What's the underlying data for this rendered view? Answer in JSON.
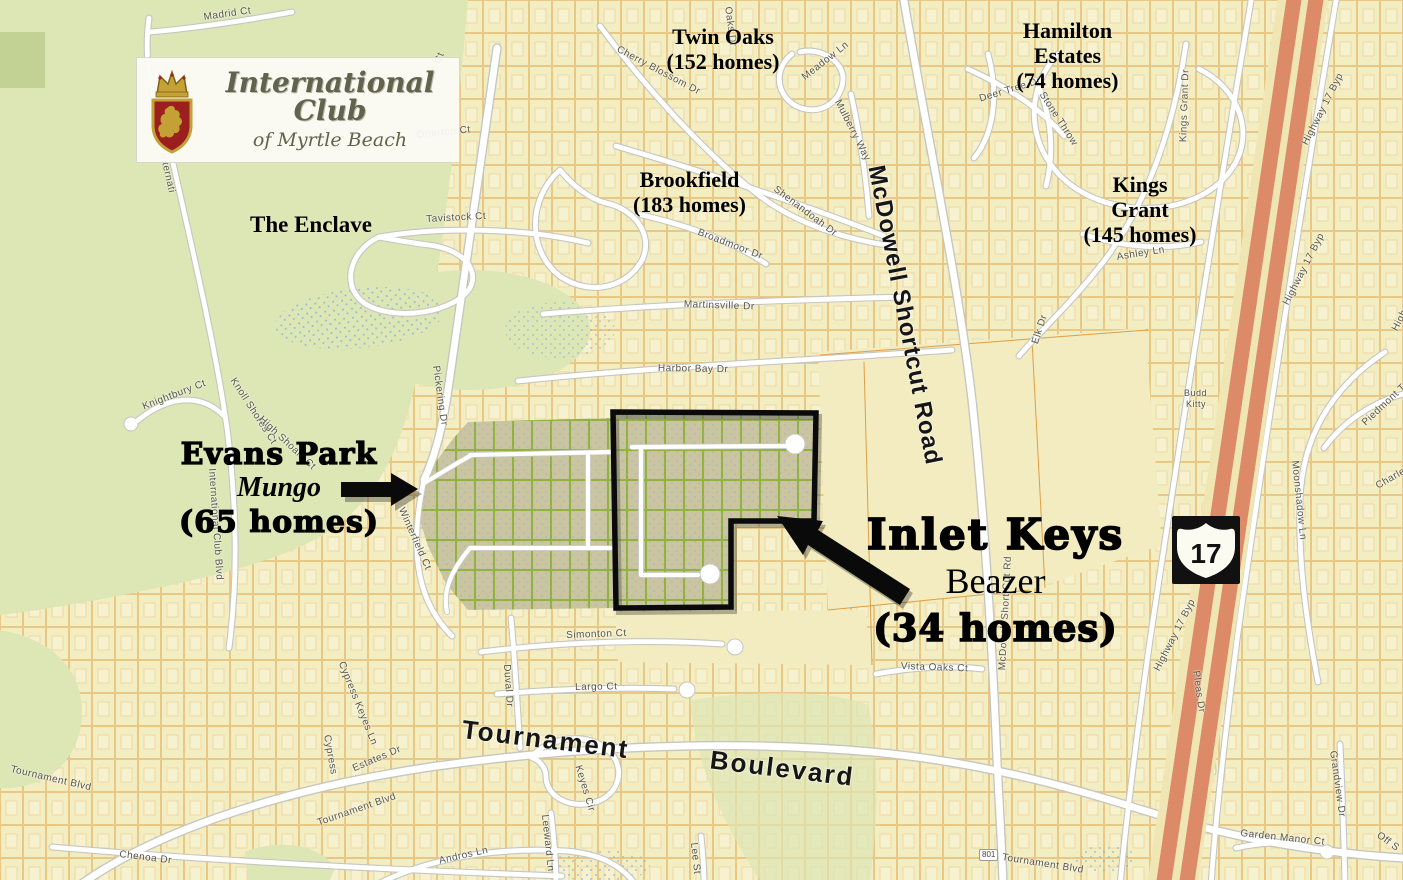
{
  "logo": {
    "title": "International Club",
    "subtitle": "of Myrtle Beach"
  },
  "shield": {
    "route": "17"
  },
  "markers": {
    "route_801": "801"
  },
  "neighborhoods": {
    "twin_oaks": {
      "name": "Twin Oaks",
      "homes": "(152 homes)"
    },
    "hamilton": {
      "name": "Hamilton\nEstates",
      "homes": "(74 homes)"
    },
    "brookfield": {
      "name": "Brookfield",
      "homes": "(183 homes)"
    },
    "kings_grant": {
      "name": "Kings\nGrant",
      "homes": "(145 homes)"
    },
    "enclave": {
      "name": "The Enclave"
    },
    "evans_park": {
      "name": "Evans Park",
      "builder": "Mungo",
      "homes": "(65 homes)"
    },
    "inlet_keys": {
      "name": "Inlet Keys",
      "builder": "Beazer",
      "homes": "(34 homes)"
    }
  },
  "streets": [
    {
      "t": "Madrid Ct",
      "x": 203,
      "y": 12,
      "r": -8
    },
    {
      "t": "Marsh Ct",
      "x": 420,
      "y": 92,
      "r": -68
    },
    {
      "t": "Otterton Ct",
      "x": 416,
      "y": 130,
      "r": -6
    },
    {
      "t": "Oaks Dr",
      "x": 733,
      "y": 6,
      "r": 82
    },
    {
      "t": "Cherry Blossom Dr",
      "x": 620,
      "y": 44,
      "r": 28
    },
    {
      "t": "Meadow Ln",
      "x": 800,
      "y": 74,
      "r": -38
    },
    {
      "t": "Mulberry Way",
      "x": 842,
      "y": 98,
      "r": 63
    },
    {
      "t": "Deer Tree Dr",
      "x": 978,
      "y": 94,
      "r": -17
    },
    {
      "t": "Stone Throw",
      "x": 1046,
      "y": 90,
      "r": 57
    },
    {
      "t": "Kings Grant Dr",
      "x": 1178,
      "y": 142,
      "r": -88
    },
    {
      "t": "Highway 17 Byp",
      "x": 1300,
      "y": 142,
      "r": -63
    },
    {
      "t": "Tavistock Ct",
      "x": 426,
      "y": 214,
      "r": -3
    },
    {
      "t": "Shenandoah Dr",
      "x": 778,
      "y": 184,
      "r": 37
    },
    {
      "t": "Broadmoor Dr",
      "x": 700,
      "y": 227,
      "r": 21
    },
    {
      "t": "Ashley Ln",
      "x": 1116,
      "y": 252,
      "r": -9
    },
    {
      "t": "Martinsville Dr",
      "x": 684,
      "y": 299,
      "r": 2
    },
    {
      "t": "Highway 17 Byp",
      "x": 1281,
      "y": 302,
      "r": -63
    },
    {
      "t": "Elk Dr",
      "x": 1030,
      "y": 342,
      "r": -72
    },
    {
      "t": "Harbor Bay Dr",
      "x": 658,
      "y": 363,
      "r": 1
    },
    {
      "t": "Piedmont Tr",
      "x": 1360,
      "y": 420,
      "r": -43
    },
    {
      "t": "Budd",
      "x": 1184,
      "y": 388,
      "r": 0,
      "s": 9
    },
    {
      "t": "Kitty",
      "x": 1186,
      "y": 399,
      "r": 0,
      "s": 9
    },
    {
      "t": "Knightbury Ct",
      "x": 141,
      "y": 402,
      "r": -21
    },
    {
      "t": "Knoll Shores Ct",
      "x": 237,
      "y": 376,
      "r": 57
    },
    {
      "t": "High Shoals Ct",
      "x": 264,
      "y": 414,
      "r": 43
    },
    {
      "t": "Pickering Dr",
      "x": 441,
      "y": 365,
      "r": 82
    },
    {
      "t": "Internati",
      "x": 168,
      "y": 152,
      "r": 77
    },
    {
      "t": "International Club Blvd",
      "x": 217,
      "y": 468,
      "r": 86
    },
    {
      "t": "Charleston",
      "x": 1374,
      "y": 482,
      "r": -30
    },
    {
      "t": "Moonshadow Ln",
      "x": 1300,
      "y": 460,
      "r": 84
    },
    {
      "t": "Winterfield Ct",
      "x": 406,
      "y": 506,
      "r": 66
    },
    {
      "t": "McDowell Shortcut Road",
      "x": 889,
      "y": 163,
      "r": 79,
      "s": 24,
      "w": 700,
      "c": "#161616",
      "ls": 1
    },
    {
      "t": "McDowell Short Cut Rd",
      "x": 997,
      "y": 670,
      "r": -87
    },
    {
      "t": "Highway 17 Byp",
      "x": 1152,
      "y": 668,
      "r": -63
    },
    {
      "t": "Highway 17 Byp",
      "x": 1390,
      "y": 328,
      "r": -63
    },
    {
      "t": "Vista Oaks Ct",
      "x": 901,
      "y": 661,
      "r": 2
    },
    {
      "t": "Simonton Ct",
      "x": 566,
      "y": 630,
      "r": -2
    },
    {
      "t": "Largo Ct",
      "x": 575,
      "y": 682,
      "r": -1
    },
    {
      "t": "Duval Dr",
      "x": 512,
      "y": 664,
      "r": 86
    },
    {
      "t": "Tournament   Boulevard",
      "x": 464,
      "y": 714,
      "r": 7,
      "s": 26,
      "w": 700,
      "c": "#161616",
      "ls": 2,
      "ws": 18
    },
    {
      "t": "Cypress Keyes Ln",
      "x": 346,
      "y": 660,
      "r": 68
    },
    {
      "t": "Cypress",
      "x": 332,
      "y": 734,
      "r": 80
    },
    {
      "t": "Estates Dr",
      "x": 351,
      "y": 764,
      "r": -23
    },
    {
      "t": "Keyes Cir",
      "x": 583,
      "y": 764,
      "r": 73
    },
    {
      "t": "Pleas Dr",
      "x": 1201,
      "y": 670,
      "r": 82
    },
    {
      "t": "Tournament Blvd",
      "x": 12,
      "y": 764,
      "r": 13
    },
    {
      "t": "Tournament Blvd",
      "x": 316,
      "y": 818,
      "r": -19
    },
    {
      "t": "Chenoa Dr",
      "x": 120,
      "y": 849,
      "r": 7
    },
    {
      "t": "Grandview Dr",
      "x": 1338,
      "y": 750,
      "r": 82
    },
    {
      "t": "Leeward Ln",
      "x": 550,
      "y": 814,
      "r": 84
    },
    {
      "t": "Andros Ln",
      "x": 438,
      "y": 856,
      "r": -13
    },
    {
      "t": "Lee St",
      "x": 699,
      "y": 842,
      "r": 84
    },
    {
      "t": "Tournament Blvd",
      "x": 1003,
      "y": 852,
      "r": 9
    },
    {
      "t": "Garden Manor Ct",
      "x": 1241,
      "y": 828,
      "r": 6
    },
    {
      "t": "Off S",
      "x": 1381,
      "y": 830,
      "r": 36
    }
  ]
}
